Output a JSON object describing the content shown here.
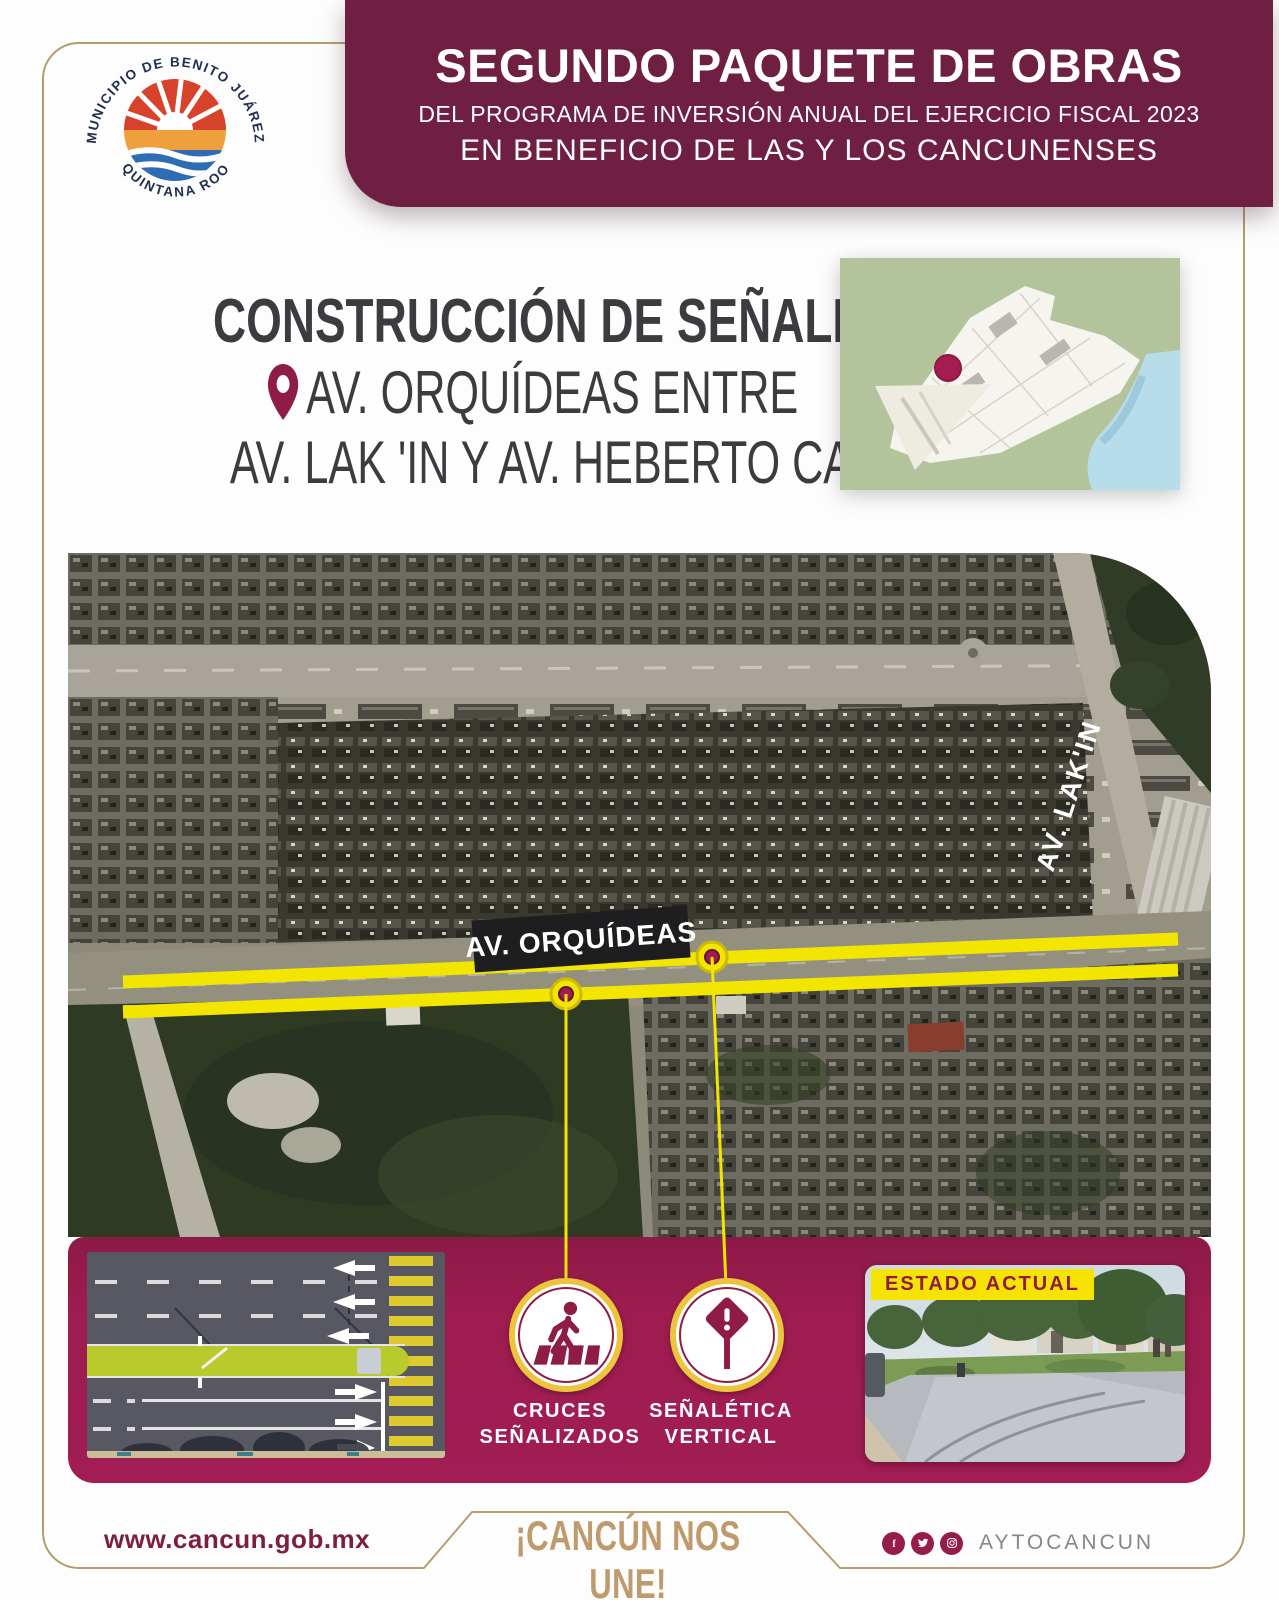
{
  "branding": {
    "org_arc_top": "MUNICIPIO DE BENITO JUÁREZ",
    "org_arc_bottom": "QUINTANA ROO"
  },
  "header": {
    "title": "SEGUNDO PAQUETE DE OBRAS",
    "subtitle": "DEL PROGRAMA DE INVERSIÓN ANUAL DEL EJERCICIO FISCAL 2023",
    "tagline": "EN BENEFICIO DE LAS Y LOS CANCUNENSES"
  },
  "project": {
    "work_type": "CONSTRUCCIÓN DE SEÑALÉTICA",
    "location_line1": "AV. ORQUÍDEAS ENTRE",
    "location_line2": "AV. LAK 'IN Y AV. HEBERTO CASTILLO"
  },
  "map": {
    "road_label": "AV. ORQUÍDEAS",
    "cross_street_label": "AV. LAK'IN"
  },
  "features": [
    {
      "icon": "pedestrian-crossing",
      "line1": "CRUCES",
      "line2": "SEÑALIZADOS"
    },
    {
      "icon": "vertical-sign",
      "line1": "SEÑALÉTICA",
      "line2": "VERTICAL"
    }
  ],
  "current_state": {
    "tag": "ESTADO ACTUAL"
  },
  "footer": {
    "website": "www.cancun.gob.mx",
    "slogan": "¡CANCÚN NOS UNE!",
    "social_handle": "AYTOCANCUN",
    "social_icons": [
      "facebook",
      "twitter",
      "instagram"
    ]
  },
  "colors": {
    "banner_maroon": "#6e1f42",
    "panel_magenta": "#9e1c50",
    "highlight_yellow": "#f2e600",
    "gold_border": "#b59d6b",
    "icon_maroon": "#8e1c46",
    "title_gray": "#3c3b3f"
  }
}
